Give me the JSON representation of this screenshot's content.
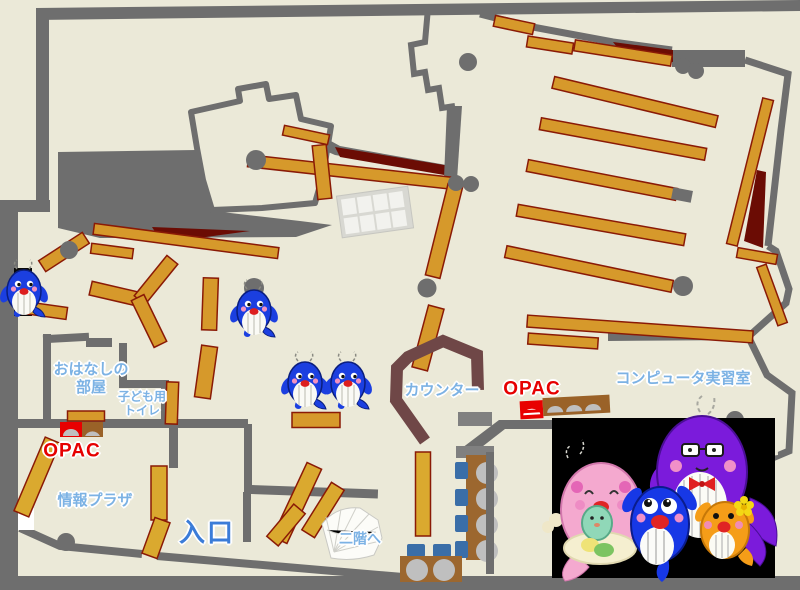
{
  "page": {
    "title": "library-floor-map"
  },
  "map": {
    "colors": {
      "background": "#EBE9D8",
      "wall": "#6E6E6E",
      "shelf": "#D6992B",
      "accent_dark_red": "#6B0C04",
      "counter": "#6F4747",
      "label_blue": "#7CB2E4",
      "entrance_blue": "#3B7CD8",
      "opac_red": "#E60000",
      "chair_blue": "#3A6EA8"
    },
    "labels": {
      "storytelling_room_line1": "おはなしの",
      "storytelling_room_line2": "部屋",
      "kids_toilet_line1": "子ども用",
      "kids_toilet_line2": "トイレ",
      "opac_left": "OPAC",
      "opac_right": "OPAC",
      "info_plaza": "情報プラザ",
      "entrance": "入口",
      "to_second_floor": "二階へ",
      "counter": "カウンター",
      "computer_room": "コンピュータ実習室"
    }
  }
}
